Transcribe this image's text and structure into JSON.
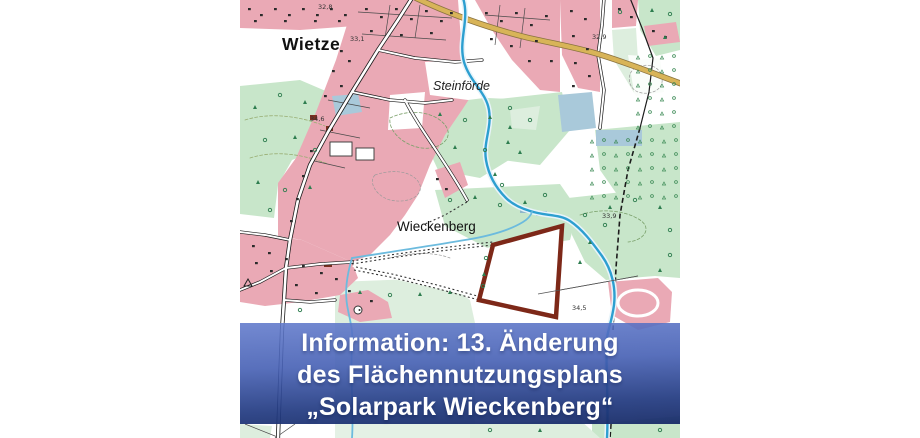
{
  "page": {
    "background": "#ffffff"
  },
  "map": {
    "kind": "topographic-map-extract",
    "labels": {
      "town_main": "Wietze",
      "district_north": "Steinförde",
      "district_south": "Wieckenberg",
      "elevations": {
        "e1": "32,8",
        "e2": "33,1",
        "e3": "32,9",
        "e4": "34,6",
        "e5": "33,9",
        "e6": "34,5"
      }
    },
    "colors": {
      "residential": "#eaa9b5",
      "forest": "#c8e6ca",
      "meadow": "#ddeede",
      "water": "#2d9fd0",
      "water_light": "#6cbbde",
      "lake": "#a9c9da",
      "major_road": "#d8b458",
      "plan_boundary": "#7d2818"
    }
  },
  "banner": {
    "line1": "Information: 13. Änderung",
    "line2": "des Flächennutzungsplans",
    "line3": "„Solarpark Wieckenberg“",
    "text_color": "#ffffff",
    "background_top": "#6079cb",
    "background_bottom": "#182c68"
  }
}
